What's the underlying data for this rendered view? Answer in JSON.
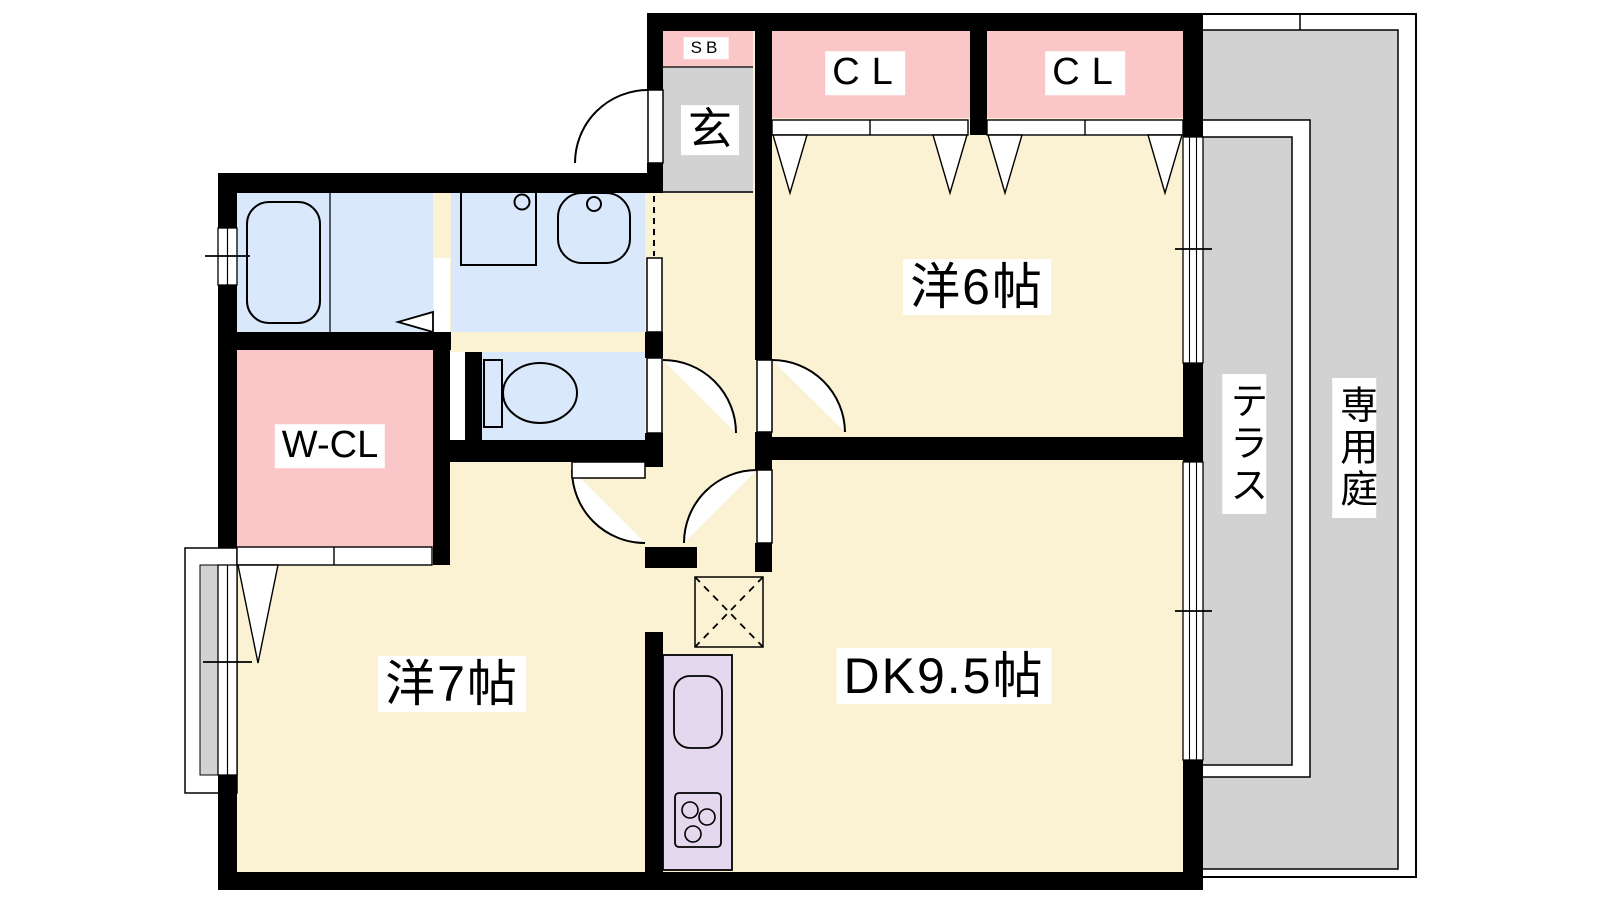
{
  "plan_title": "2DK apartment floor plan",
  "rooms": {
    "shoe_box": {
      "label": "SB"
    },
    "entrance": {
      "label": "玄"
    },
    "closet1": {
      "label": "CL"
    },
    "closet2": {
      "label": "CL"
    },
    "western6": {
      "label": "洋6帖"
    },
    "walkin_closet": {
      "label": "W-CL"
    },
    "western7": {
      "label": "洋7帖"
    },
    "dining_kitchen": {
      "label": "DK9.5帖"
    },
    "terrace": {
      "label": "テラス"
    },
    "private_garden": {
      "label": "専用庭"
    }
  },
  "colors": {
    "floor_cream": "#fbf1d3",
    "closet_pink": "#fbc6c7",
    "wet_area_blue": "#d9e8fa",
    "entry_gray": "#d2d2d2",
    "outdoor_gray": "#d2d2d2",
    "kitchen_lavender": "#e4d8ef",
    "wall_black": "#000000",
    "background": "#ffffff"
  }
}
